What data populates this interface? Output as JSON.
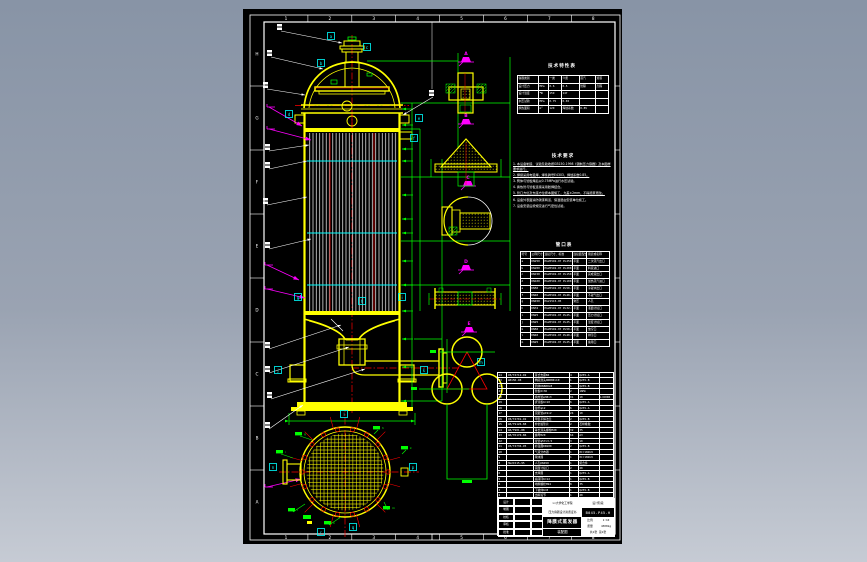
{
  "app": {
    "canvas_bg_top": "#8894a6",
    "canvas_bg_bottom": "#c6cbd4",
    "sheet_bg": "#000000"
  },
  "palette": {
    "line_white": "#ffffff",
    "line_yellow": "#ffff00",
    "line_green": "#00ff00",
    "line_cyan": "#00ffff",
    "line_red": "#ff0000",
    "line_magenta": "#ff00ff"
  },
  "frame": {
    "zone_letters": [
      "H",
      "G",
      "F",
      "E",
      "D",
      "C",
      "B",
      "A"
    ],
    "zone_numbers": [
      "1",
      "2",
      "3",
      "4",
      "5",
      "6",
      "7",
      "8"
    ]
  },
  "annotations": {
    "weld_letters": [
      "a",
      "b",
      "c",
      "d",
      "e",
      "f",
      "g",
      "h",
      "i",
      "j",
      "k",
      "l",
      "m",
      "n",
      "p",
      "q",
      "r"
    ],
    "detail_letters": [
      "A",
      "B",
      "C",
      "D",
      "E"
    ],
    "circle_tags": [
      "g",
      "h",
      "i",
      "k",
      "l",
      "m",
      "n"
    ]
  },
  "tech_table": {
    "title": "技术特性表",
    "rows": [
      [
        "容器类别",
        "",
        "一类",
        "介质",
        "蒸汽",
        "溶液"
      ],
      [
        "设计压力",
        "MPa",
        "0.6",
        "0.5",
        "管程",
        "壳程"
      ],
      [
        "设计温度",
        "℃",
        "159",
        "147",
        "",
        ""
      ],
      [
        "水压试验",
        "MPa",
        "0.75",
        "0.65",
        "",
        ""
      ],
      [
        "换热面积",
        "m²",
        "120",
        "焊缝系数",
        "0.85",
        ""
      ]
    ]
  },
  "notes": {
    "title": "技术要求",
    "items": [
      "1. 本设备制造、试验及验收按GB150-1998《钢制压力容器》及本图样要求进行。",
      "2. 焊接采用电弧焊，焊条牌号E4303，焊缝系数0.85。",
      "3. 筒体与管板焊后以0.75MPa进行水压试验。",
      "4. 换热管与管板连接采用胀焊结合。",
      "5. 管口方位及支座方位按本图施工，允差±2mm，不得随意更改。",
      "6. 设备外表面涂防锈漆两道，保温层由安装单位施工。",
      "7. 设备安装后按规定进行气密性试验。"
    ]
  },
  "nozzle_table": {
    "title": "管口表",
    "headers": [
      "符号",
      "公称尺寸",
      "连接尺寸、标准",
      "连接面型式",
      "用途或名称"
    ],
    "rows": [
      [
        "a",
        "DN250",
        "HG20592-97 PL250-0.6",
        "平面",
        "二次蒸汽出口"
      ],
      [
        "b",
        "DN200",
        "HG20592-97 PL200-0.6",
        "平面",
        "料液进口"
      ],
      [
        "c",
        "DN150",
        "HG20592-97 PL150-0.6",
        "平面",
        "完成液出口"
      ],
      [
        "d",
        "DN100",
        "HG20592-97 PL100-1.0",
        "平面",
        "加热蒸汽进口"
      ],
      [
        "e",
        "DN50",
        "HG20592-97 PL50-1.0",
        "平面",
        "冷凝水出口"
      ],
      [
        "f",
        "DN40",
        "HG20592-97 PL40-1.0",
        "平面",
        "不凝气出口"
      ],
      [
        "g",
        "DN450",
        "HG21515-95",
        "常压",
        "人孔"
      ],
      [
        "h",
        "DN32",
        "HG20592-97 PL32-1.0",
        "平面",
        "液面计接口"
      ],
      [
        "i",
        "DN25",
        "HG20592-97 PL25-1.0",
        "平面",
        "压力计接口"
      ],
      [
        "j",
        "DN25",
        "HG20592-97 PL25-1.0",
        "平面",
        "温度计接口"
      ],
      [
        "k",
        "DN50",
        "HG20592-97 PL50-0.6",
        "平面",
        "放空口"
      ],
      [
        "l",
        "DN40",
        "HG20592-97 PL40-0.6",
        "平面",
        "排污口"
      ],
      [
        "m",
        "DN25",
        "HG20592-97 PL25-0.6",
        "平面",
        "备用口"
      ]
    ]
  },
  "bom": {
    "headers": [
      "件号",
      "图号或标准号",
      "名称",
      "数量",
      "材料",
      "备注"
    ],
    "rows": [
      [
        "24",
        "JB/T4712-92",
        "耳式支座B4",
        "4",
        "Q235-A",
        ""
      ],
      [
        "23",
        "GB150-98",
        "椭圆封头DN800×10",
        "1",
        "Q235-B",
        ""
      ],
      [
        "22",
        "",
        "筒体DN800×8",
        "1",
        "Q235-B",
        ""
      ],
      [
        "21",
        "",
        "管板δ=36",
        "2",
        "16Mn",
        ""
      ],
      [
        "20",
        "",
        "换热管φ38×3",
        "91",
        "10",
        "L=6000"
      ],
      [
        "19",
        "",
        "折流板δ=10",
        "6",
        "Q235-A",
        ""
      ],
      [
        "18",
        "",
        "拉杆φ12",
        "6",
        "Q235-A",
        ""
      ],
      [
        "17",
        "",
        "定距管φ19×2",
        "24",
        "10",
        ""
      ],
      [
        "16",
        "JB/T4701-92",
        "甲型平焊法兰",
        "2",
        "Q235-B",
        ""
      ],
      [
        "15",
        "GB/T9126-88",
        "非金属垫片",
        "2",
        "石棉橡胶",
        ""
      ],
      [
        "14",
        "GB/T901-88",
        "等长双头螺柱M20",
        "32",
        "35",
        ""
      ],
      [
        "13",
        "GB/T6170-86",
        "螺母M20",
        "64",
        "A3",
        ""
      ],
      [
        "12",
        "",
        "接管φ57×3.5",
        "3",
        "10",
        ""
      ],
      [
        "11",
        "JB/T4736-95",
        "补强圈DN100",
        "2",
        "Q235-B",
        ""
      ],
      [
        "10",
        "",
        "气液分布器",
        "1",
        "0Cr18Ni9",
        ""
      ],
      [
        "9",
        "",
        "除沫器",
        "1",
        "0Cr18Ni9",
        ""
      ],
      [
        "8",
        "HG21515-95",
        "人孔DN450",
        "1",
        "组合件",
        ""
      ],
      [
        "7",
        "",
        "液面计接口",
        "2",
        "20",
        ""
      ],
      [
        "6",
        "",
        "支撑圈",
        "1",
        "Q235-A",
        ""
      ],
      [
        "5",
        "",
        "底座环δ=12",
        "1",
        "Q235-B",
        ""
      ],
      [
        "4",
        "",
        "地脚螺栓M24",
        "8",
        "35",
        ""
      ],
      [
        "3",
        "",
        "下锥体δ=8",
        "1",
        "Q235-B",
        ""
      ],
      [
        "2",
        "",
        "出料短节",
        "1",
        "20",
        ""
      ],
      [
        "1",
        "",
        "裙座筒体δ=8",
        "1",
        "Q235-B",
        ""
      ]
    ]
  },
  "title_block": {
    "company": "××大学化工学院",
    "cert": "压力容器设计资质证书",
    "drawing_name": "降膜式蒸发器",
    "drawing_type": "装配图",
    "drawing_no": "B045-P45-H",
    "scale_label": "比例",
    "scale": "1:10",
    "weight_label": "质量",
    "weight": "4300kg",
    "sheet": "共1张 第1张",
    "stage": "设计阶段",
    "sig_rows": [
      "设计",
      "制图",
      "校核",
      "审核",
      "批准"
    ]
  }
}
